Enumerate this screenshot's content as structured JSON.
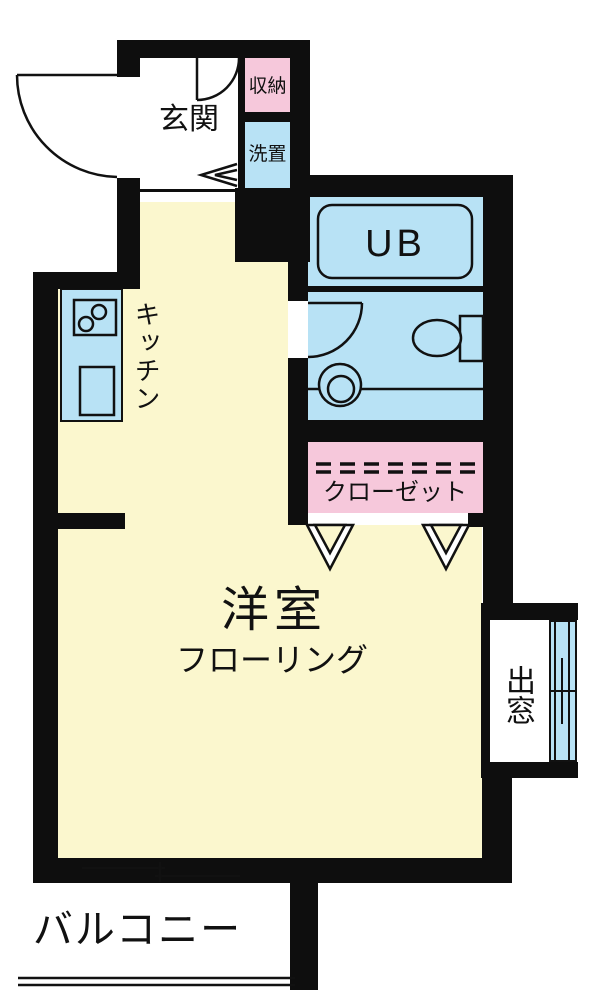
{
  "floorplan": {
    "type": "apartment-floor-plan",
    "labels": {
      "entrance": "玄関",
      "storage": "収納",
      "laundry": "洗置",
      "unit_bath": "UB",
      "kitchen": "キッチン",
      "closet": "クローゼット",
      "main_room": "洋室",
      "flooring": "フローリング",
      "bay_window": "出窓",
      "balcony": "バルコニー"
    },
    "colors": {
      "room_floor_yellow": "#FBF7CE",
      "water_area_blue": "#B8E2F5",
      "storage_pink": "#F6C8DB",
      "wall_black": "#0E0E0E",
      "line_black": "#111111",
      "background_white": "#FFFFFF"
    }
  }
}
